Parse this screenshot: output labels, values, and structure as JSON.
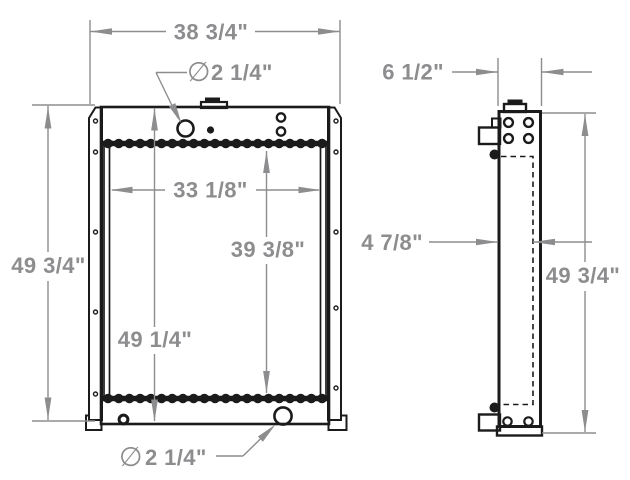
{
  "drawing": {
    "background_color": "#ffffff",
    "line_color": "#1b1b1b",
    "dimension_color": "#8d8d8f",
    "front_view": {
      "overall_width": "38 3/4\"",
      "overall_height": "49 3/4\"",
      "tank_to_tank_height": "49 1/4\"",
      "core_width": "33 1/8\"",
      "core_height": "39 3/8\"",
      "top_port": {
        "symbol": "∅",
        "value": "2 1/4\""
      },
      "bottom_port": {
        "symbol": "∅",
        "value": "2 1/4\""
      }
    },
    "side_view": {
      "overall_depth": "6 1/2\"",
      "core_depth": "4 7/8\"",
      "overall_height": "49 3/4\""
    }
  }
}
